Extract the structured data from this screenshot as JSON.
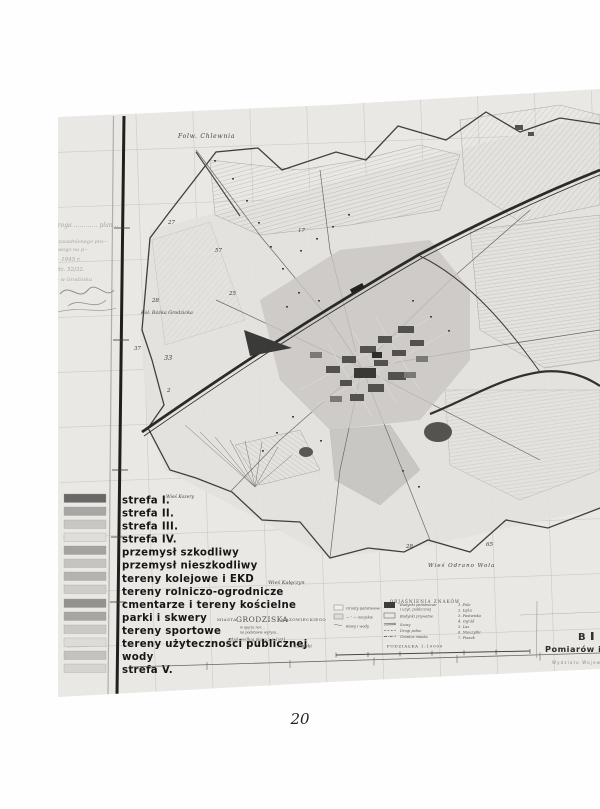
{
  "page": {
    "number": "20"
  },
  "scan": {
    "handwriting": [
      "— droga ………… plan…",
      "t. uzasadnionego pra—",
      "—owego na p—",
      "— 1945 r.",
      "L. dz. 52/32.",
      "— w Grodzisku"
    ]
  },
  "map": {
    "labels": {
      "folw_chlewnia": "Folw. Chlewnia",
      "kol_rozka": "Kol. Różka Grodzicka",
      "wies_kozery": "Wieś Kozery",
      "wies_kaleczyn": "Wieś Kałęczyn",
      "wies_odrano": "Wieś Odrano Wola"
    },
    "numbers": [
      "27",
      "57",
      "17",
      "25",
      "28",
      "37",
      "33",
      "2",
      "28",
      "65"
    ],
    "title": {
      "m1": "MIASTA",
      "m2": "GRODZISKA",
      "m3": "MAZOWIECKIEGO",
      "s1": "w ujęciu nor…",
      "s2": "na podstawie wyrysu…",
      "s3": "Zdjął według planu z r. 1931",
      "s4": "… Czapski"
    },
    "key": {
      "heading": "OBJAŚNIENIA ZNAKÓW",
      "col1": [
        "Grunty państwowe",
        "— ″ — miejskie",
        "Rowy i wody"
      ],
      "col2": [
        "Budynki państwowe",
        "i użyt. publicznej",
        "Budynki prywatne",
        "Szosy",
        "Drogi polne",
        "Granica miasta"
      ],
      "col3": [
        "1. Pole",
        "2. Łąka",
        "3. Pastwisko",
        "4. Ogród",
        "5. Las",
        "6. Nieużytki",
        "7. Piasek"
      ],
      "scale": "PODZIAŁKA 1:10000"
    },
    "stamp": {
      "l1": "B",
      "l2": "Pomiarów i",
      "l3": "Wydziału Wojew."
    }
  },
  "zones": {
    "items": [
      {
        "label": "strefa I.",
        "swatch": "#686866"
      },
      {
        "label": "strefa II.",
        "swatch": "#a9a7a4"
      },
      {
        "label": "strefa III.",
        "swatch": "#c9c7c4"
      },
      {
        "label": "strefa IV.",
        "swatch": "#e0dedb"
      },
      {
        "label": "przemysł szkodliwy",
        "swatch": "#a5a29f"
      },
      {
        "label": "przemysł nieszkodliwy",
        "swatch": "#c6c4c1"
      },
      {
        "label": "tereny kolejowe i EKD",
        "swatch": "#b5b3b0"
      },
      {
        "label": "tereny rolniczo-ogrodnicze",
        "swatch": "#cfcdca"
      },
      {
        "label": "cmentarze i tereny kościelne",
        "swatch": "#94928f"
      },
      {
        "label": "parki i skwery",
        "swatch": "#a8a5a0"
      },
      {
        "label": "tereny sportowe",
        "swatch": "#cbc9c6"
      },
      {
        "label": "tereny użyteczności publicznej",
        "swatch": "#dedcd9"
      },
      {
        "label": "wody",
        "swatch": "#c4c2bf"
      },
      {
        "label": "strefa V.",
        "swatch": "#d6d4d1"
      }
    ]
  }
}
